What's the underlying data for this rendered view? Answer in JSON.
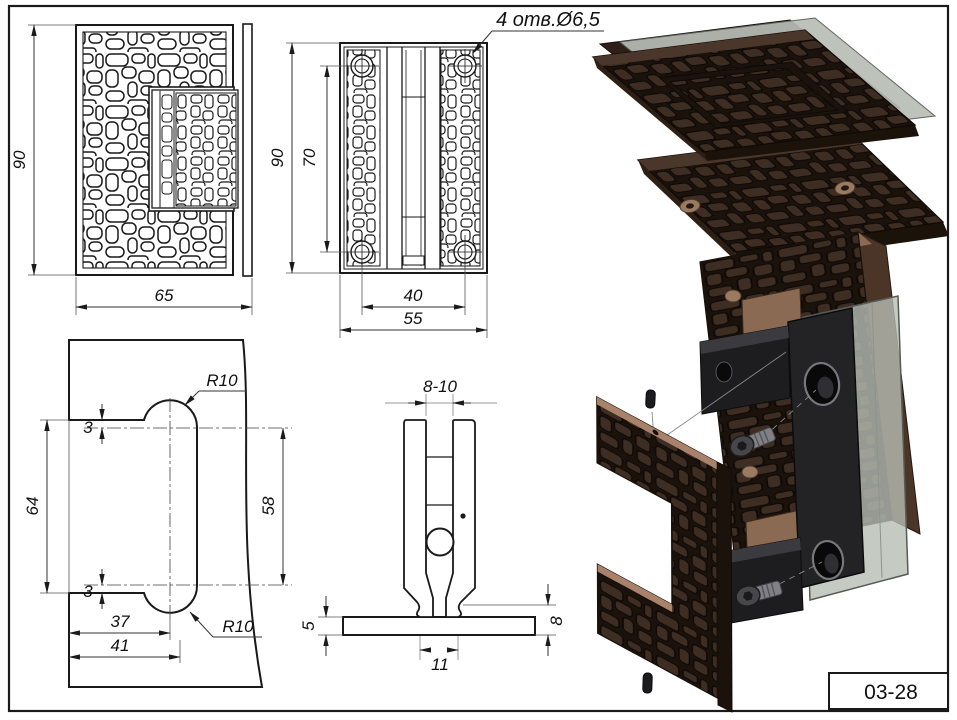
{
  "drawing": {
    "sheet_code": "03-28",
    "annotation_holes": "4 отв.Ø6,5",
    "views": {
      "plate_front": {
        "dim_height": "90",
        "dim_width": "65"
      },
      "hinge_front": {
        "dim_height": "90",
        "dim_hole_span_v": "70",
        "dim_hole_span_h": "40",
        "dim_width": "55"
      },
      "glass_cutout": {
        "dim_edge_offset_top": "3",
        "dim_notch_height": "64",
        "dim_edge_offset_bottom": "3",
        "dim_lobe_span": "58",
        "dim_center_depth": "37",
        "dim_slot_depth": "41",
        "radius_top": "R10",
        "radius_bottom": "R10"
      },
      "clamp_section": {
        "dim_glass_gap": "8-10",
        "dim_base_thickness": "5",
        "dim_flange_height": "8",
        "dim_neck_width": "11"
      }
    },
    "colors": {
      "line": "#1a1a1a",
      "plate_brown": "#3e2d22",
      "plate_groove": "#17100b",
      "copper": "#9b7a62",
      "glass": "#b7bdb4",
      "hardware_black": "#212124"
    }
  }
}
